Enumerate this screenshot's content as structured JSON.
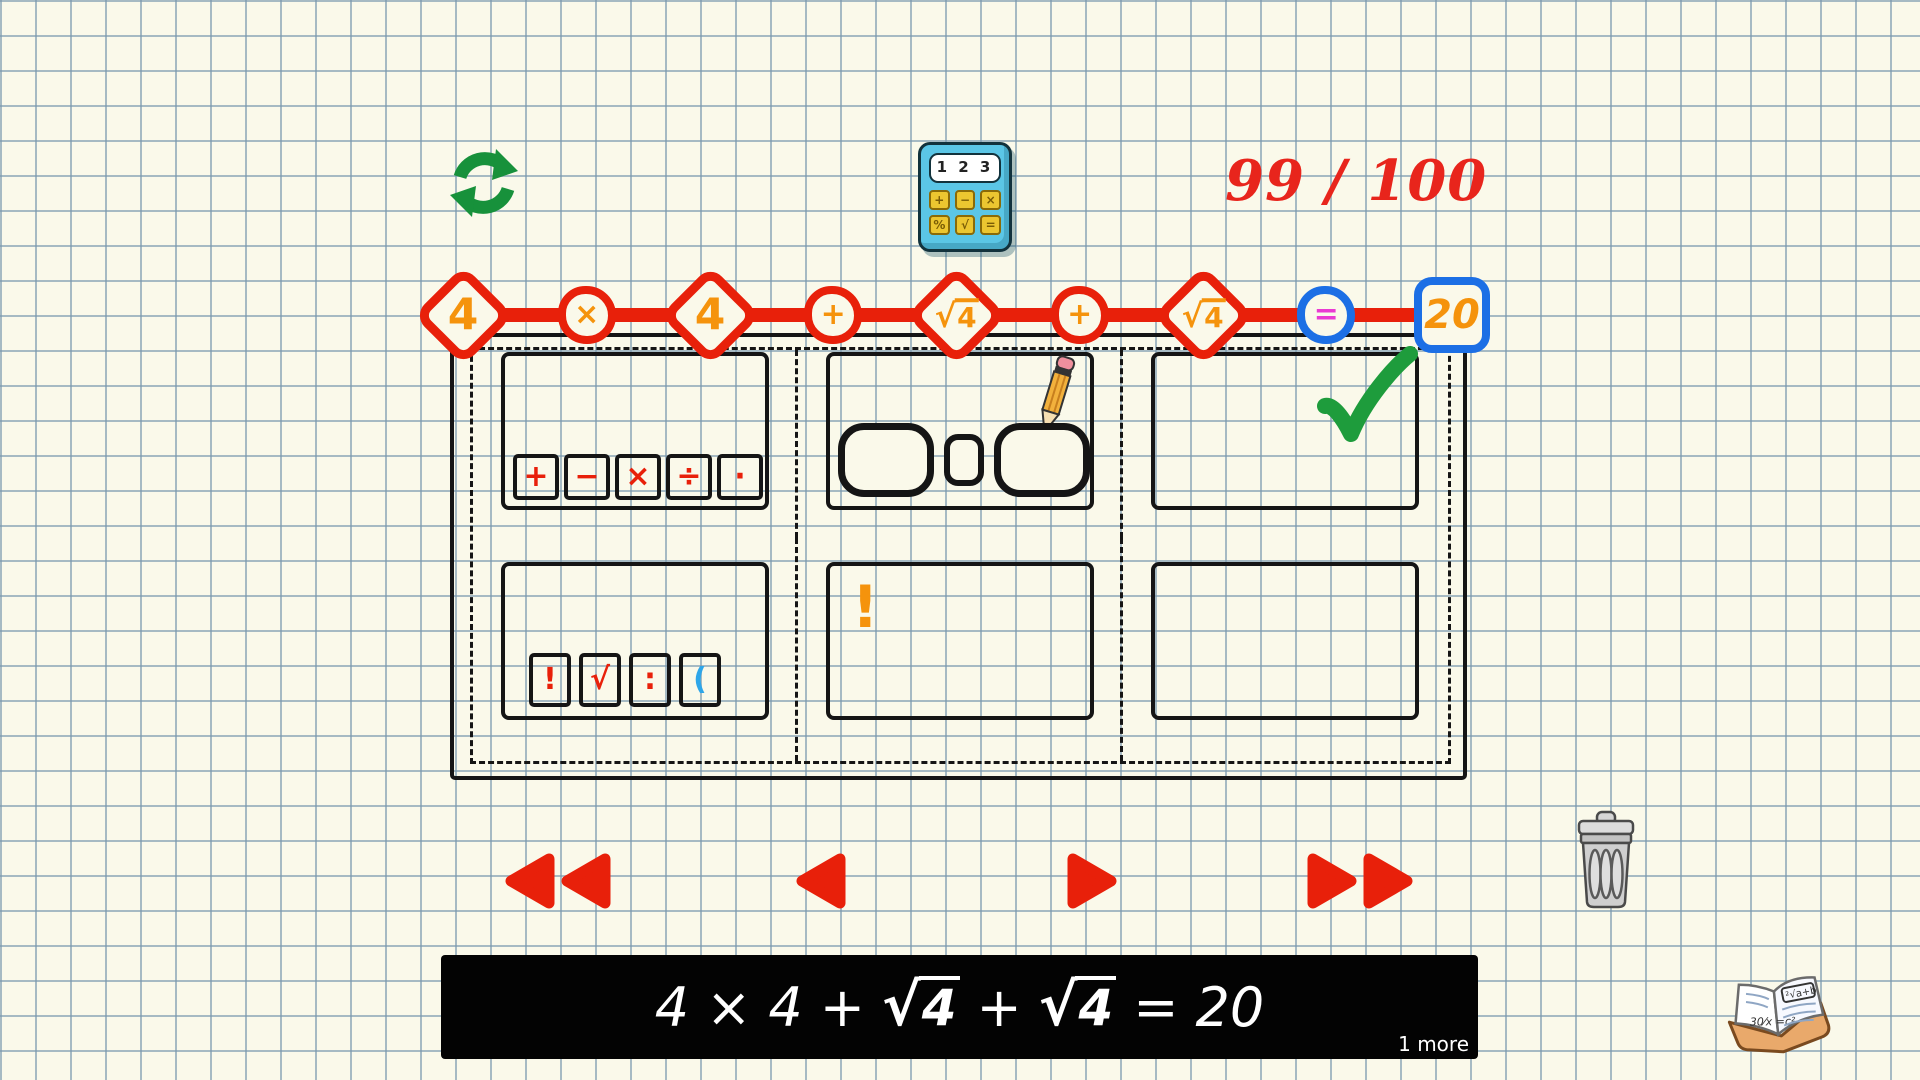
{
  "hud": {
    "score": "99 / 100",
    "calculator": {
      "display": "1 2 3",
      "buttons": [
        "+",
        "−",
        "×",
        "%",
        "√",
        "="
      ]
    }
  },
  "equation_tokens": [
    {
      "shape": "diamond",
      "border": "red",
      "color": "orange",
      "text": "4",
      "name": "number-4"
    },
    {
      "shape": "circle",
      "border": "red",
      "color": "orange",
      "text": "×",
      "name": "multiply"
    },
    {
      "shape": "diamond",
      "border": "red",
      "color": "orange",
      "text": "4",
      "name": "number-4"
    },
    {
      "shape": "circle",
      "border": "red",
      "color": "orange",
      "text": "+",
      "name": "plus"
    },
    {
      "shape": "diamond",
      "border": "red",
      "color": "orange",
      "sqrt": true,
      "root": "4",
      "name": "sqrt-4"
    },
    {
      "shape": "circle",
      "border": "red",
      "color": "orange",
      "text": "+",
      "name": "plus"
    },
    {
      "shape": "diamond",
      "border": "red",
      "color": "orange",
      "sqrt": true,
      "root": "4",
      "name": "sqrt-4"
    },
    {
      "shape": "circle",
      "border": "blue",
      "color": "magenta",
      "text": "=",
      "name": "equals"
    },
    {
      "shape": "square",
      "border": "blue",
      "color": "orange",
      "text": "20",
      "name": "result-20"
    }
  ],
  "panels": {
    "basic_operators": [
      {
        "label": "+",
        "color": "red",
        "name": "plus"
      },
      {
        "label": "−",
        "color": "red",
        "name": "minus"
      },
      {
        "label": "×",
        "color": "red",
        "name": "multiply"
      },
      {
        "label": "÷",
        "color": "red",
        "name": "divide"
      },
      {
        "label": "·",
        "color": "red",
        "name": "decimal-point"
      }
    ],
    "advanced_operators": [
      {
        "label": "!",
        "color": "red",
        "name": "factorial"
      },
      {
        "label": "√",
        "color": "red",
        "name": "square-root"
      },
      {
        "label": ":",
        "color": "red",
        "name": "ratio"
      },
      {
        "label": "(",
        "color": "blue",
        "name": "open-paren"
      }
    ],
    "hint_exclamation": "!"
  },
  "bottom_bar": {
    "segments": [
      {
        "text": "4"
      },
      {
        "text": "×"
      },
      {
        "text": "4"
      },
      {
        "text": "+"
      },
      {
        "sqrt": true,
        "root": "4"
      },
      {
        "text": "+"
      },
      {
        "sqrt": true,
        "root": "4"
      },
      {
        "text": "="
      },
      {
        "text": "20"
      }
    ],
    "more": "1 more"
  },
  "colors": {
    "red": "#E8200A",
    "orange": "#F5930C",
    "blue_accent": "#1C6FE5",
    "light_blue": "#2EA6E9",
    "magenta": "#EA3AD3",
    "green": "#1E9C3C",
    "background": "#FAF9EA",
    "black": "#151515"
  }
}
